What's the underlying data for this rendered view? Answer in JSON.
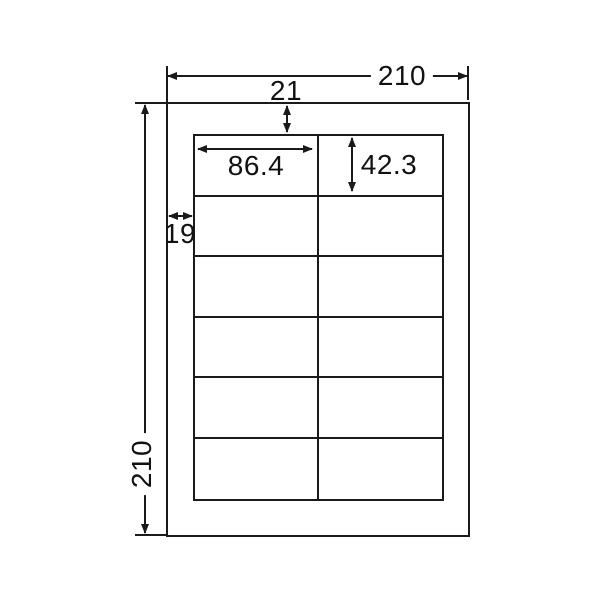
{
  "diagram": {
    "type": "label-sheet-dimension-diagram",
    "background_color": "#ffffff",
    "line_color": "#1a1a1a",
    "sheet": {
      "grid": {
        "rows": 6,
        "columns": 2,
        "label_count": 12
      }
    },
    "dimensions": {
      "sheet_width": "210",
      "sheet_height": "210",
      "top_margin": "21",
      "left_margin": "19",
      "label_width": "86.4",
      "label_height": "42.3"
    }
  }
}
